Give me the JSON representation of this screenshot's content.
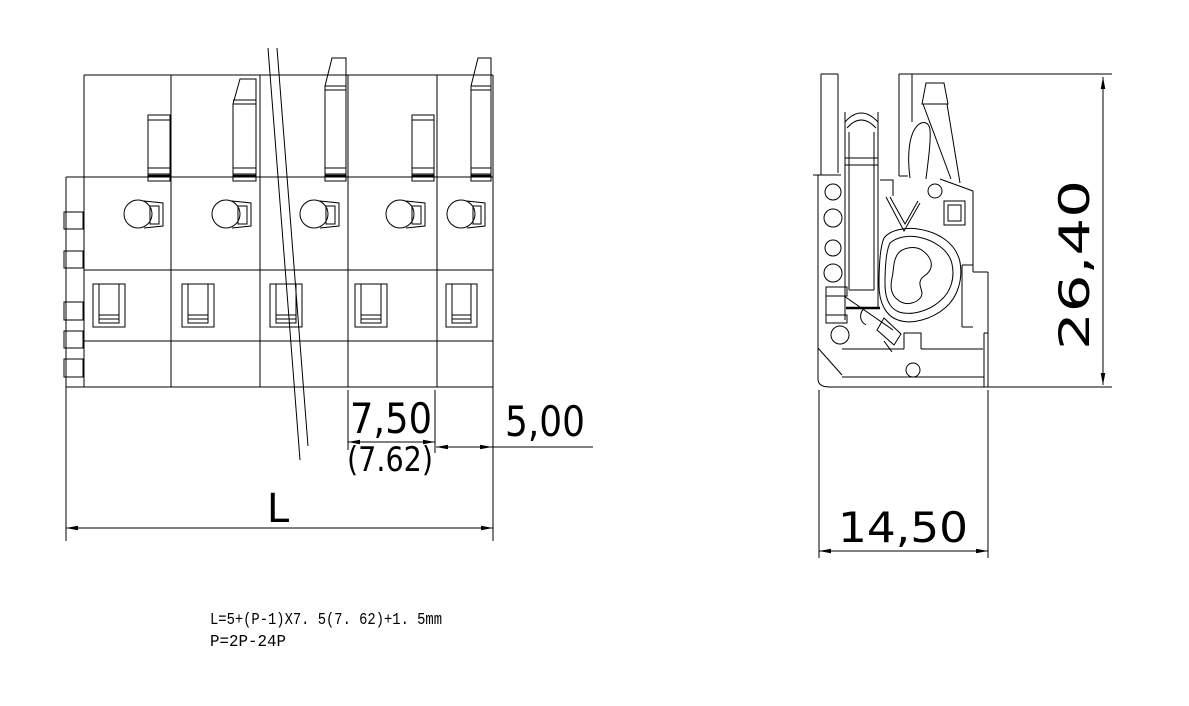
{
  "page": {
    "background_color": "#ffffff",
    "line_color": "#000000"
  },
  "front_view": {
    "dim_pitch": "7,50",
    "dim_pitch_inch": "(7.62)",
    "dim_end_margin": "5,00",
    "dim_total_length": "L"
  },
  "side_view": {
    "dim_height": "26,40",
    "dim_width": "14,50"
  },
  "notes": {
    "formula_length": "L=5+(P-1)X7. 5(7. 62)+1. 5mm",
    "formula_pole_range": "P=2P-24P"
  }
}
